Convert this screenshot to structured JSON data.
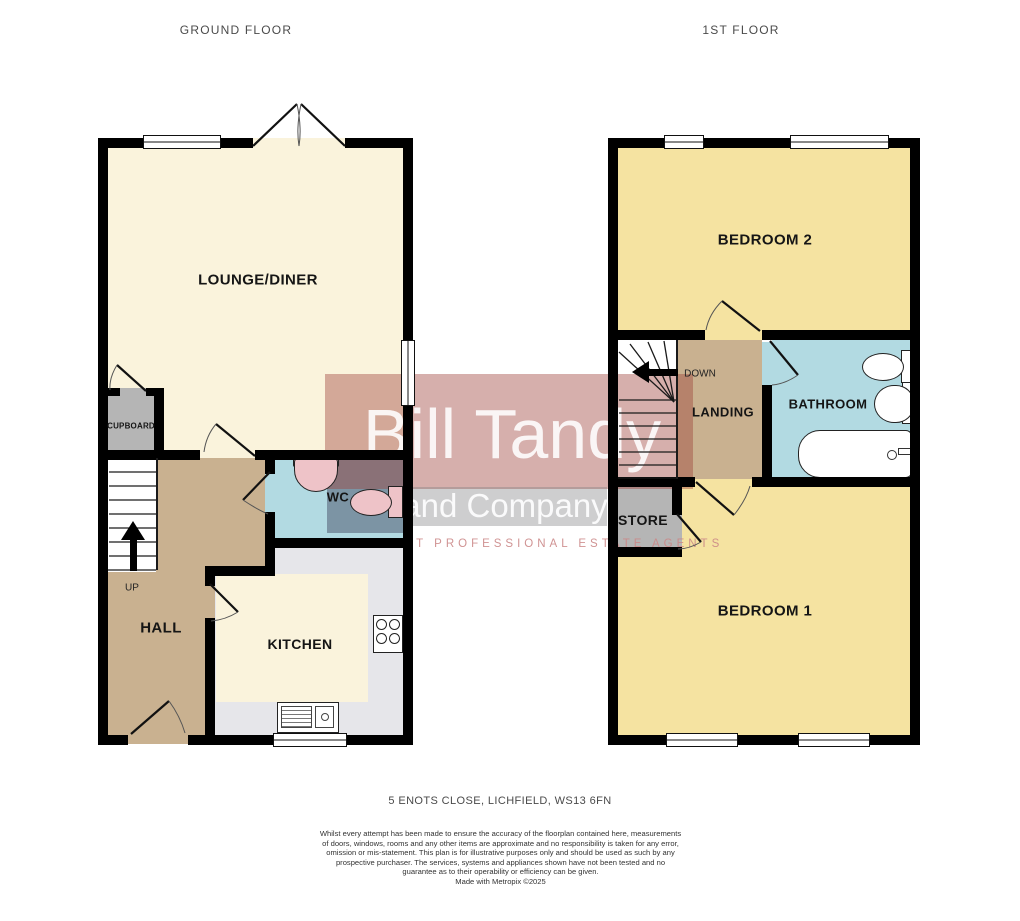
{
  "titles": {
    "ground": "GROUND FLOOR",
    "first": "1ST FLOOR"
  },
  "rooms": {
    "lounge": {
      "label": "LOUNGE/DINER"
    },
    "hall": {
      "label": "HALL"
    },
    "kitchen": {
      "label": "KITCHEN"
    },
    "wc": {
      "label": "WC"
    },
    "cupboard": {
      "label": "CUPBOARD"
    },
    "bedroom2": {
      "label": "BEDROOM 2"
    },
    "bedroom1": {
      "label": "BEDROOM 1"
    },
    "landing": {
      "label": "LANDING"
    },
    "bathroom": {
      "label": "BATHROOM"
    },
    "store": {
      "label": "STORE"
    }
  },
  "stairs": {
    "up_label": "UP",
    "down_label": "DOWN"
  },
  "watermark": {
    "line1": "Bill Tandy",
    "line2": "and Company",
    "tagline": "INDEPENDENT PROFESSIONAL ESTATE AGENTS"
  },
  "footer": {
    "address": "5 ENOTS CLOSE, LICHFIELD, WS13 6FN",
    "disclaimer": "Whilst every attempt has been made to ensure the accuracy of the floorplan contained here, measurements of doors, windows, rooms and any other items are approximate and no responsibility is taken for any error, omission or mis-statement. This plan is for illustrative purposes only and should be used as such by any prospective purchaser. The services, systems and appliances shown have not been tested and no guarantee as to their operability or efficiency can be given.",
    "credit": "Made with Metropix ©2025"
  },
  "colors": {
    "wall": "#000000",
    "lounge_kitchen_floor": "#faf3dc",
    "bedroom_floor": "#f5e3a1",
    "hall_landing_floor": "#c9b190",
    "bathroom_wc_floor": "#b2dae2",
    "cupboard_store_floor": "#b5b5b5",
    "kitchen_counter": "#e6e6ea",
    "watermark_red": "#9e3a3a",
    "watermark_gray": "#7d7d82"
  }
}
